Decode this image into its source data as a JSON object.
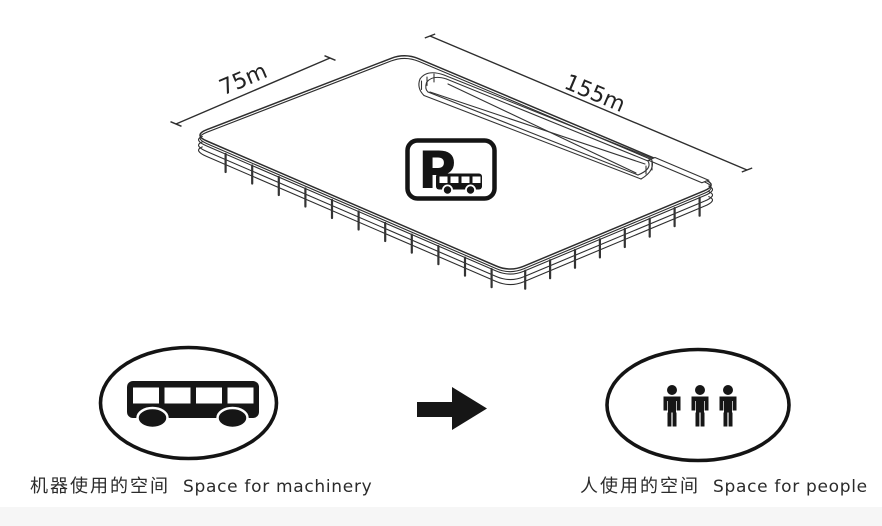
{
  "diagram": {
    "title_none": "",
    "dimensions": {
      "width_label": "75m",
      "length_label": "155m"
    },
    "roof_sign": {
      "letter": "P",
      "icon": "bus-parking-sign"
    },
    "legend": {
      "machinery": {
        "zh": "机器使用的空间",
        "en": "Space for machinery",
        "icon": "bus-icon"
      },
      "arrow_icon": "right-arrow",
      "people": {
        "zh": "人使用的空间",
        "en": "Space for people",
        "icon": "people-icon"
      }
    },
    "colors": {
      "ink": "#2e2e2e",
      "fill_icon": "#161616",
      "background": "#ffffff"
    }
  }
}
